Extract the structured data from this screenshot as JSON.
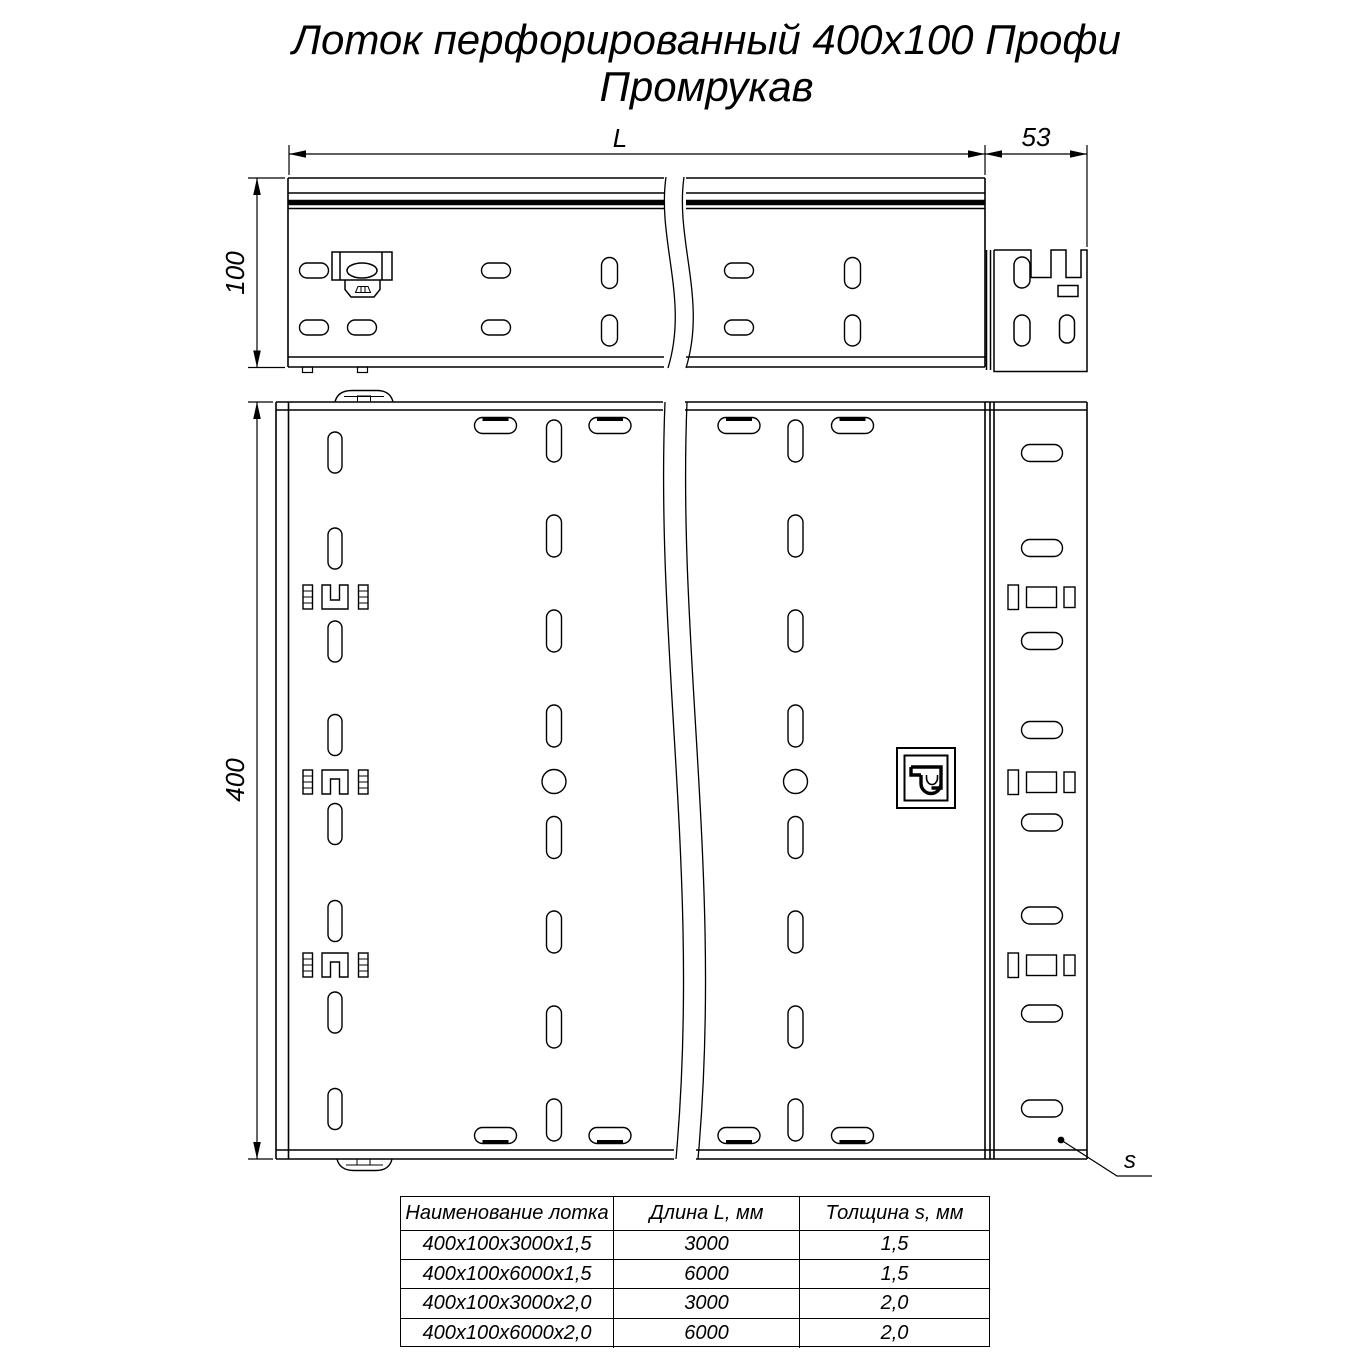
{
  "title": {
    "line1": "Лоток перфорированный 400х100 Профи",
    "line2": "Промрукав"
  },
  "dimensions": {
    "length": "L",
    "end_flange_width": "53",
    "side_height": "100",
    "tray_width": "400",
    "thickness": "s"
  },
  "table": {
    "headers": [
      "Наименование лотка",
      "Длина L, мм",
      "Толщина s, мм"
    ],
    "rows": [
      [
        "400х100х3000х1,5",
        "3000",
        "1,5"
      ],
      [
        "400х100х6000х1,5",
        "6000",
        "1,5"
      ],
      [
        "400х100х3000х2,0",
        "3000",
        "2,0"
      ],
      [
        "400х100х6000х2,0",
        "6000",
        "2,0"
      ]
    ]
  },
  "colors": {
    "line": "#000000",
    "background": "#ffffff"
  }
}
